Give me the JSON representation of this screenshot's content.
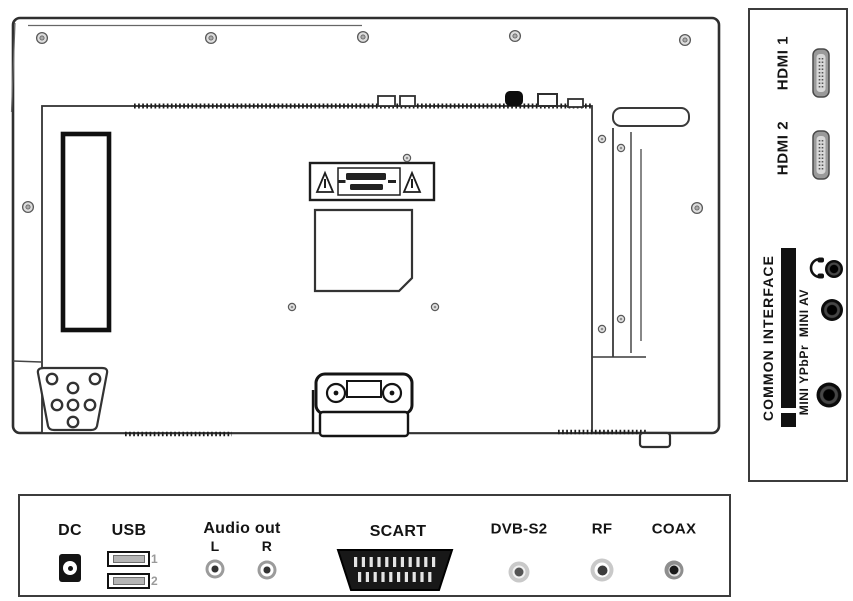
{
  "side_panel": {
    "hdmi1": {
      "label": "HDMI 1",
      "icon": "hdmi-connector-icon"
    },
    "hdmi2": {
      "label": "HDMI 2",
      "icon": "hdmi-connector-icon"
    },
    "common_interface": {
      "label": "COMMON INTERFACE",
      "icon": "ci-card-slot"
    },
    "headphone": {
      "icon": "headphone-icon"
    },
    "mini_av": {
      "label": "MINI AV",
      "icon": "mini-jack"
    },
    "mini_ypbpr": {
      "label": "MINI YPbPr",
      "icon": "mini-jack"
    }
  },
  "bottom_panel": {
    "dc": {
      "label": "DC",
      "icon": "dc-power-jack"
    },
    "usb": {
      "label": "USB",
      "numbers": [
        "1",
        "2"
      ],
      "icon": "usb-ports"
    },
    "audio_out": {
      "label": "Audio out",
      "left": "L",
      "right": "R",
      "icon": "rca-jacks"
    },
    "scart": {
      "label": "SCART",
      "icon": "scart-connector"
    },
    "dvb_s2": {
      "label": "DVB-S2",
      "icon": "coax-jack"
    },
    "rf": {
      "label": "RF",
      "icon": "coax-jack"
    },
    "coax": {
      "label": "COAX",
      "icon": "coax-jack"
    }
  },
  "rear_view": {
    "caution_label": {
      "icon": "warning-triangle-icon"
    }
  },
  "colors": {
    "line": "#2f2f2f",
    "dark": "#111111",
    "connector_gray": "#9a9a9a",
    "jack_ring_light": "#c9c9c9",
    "muted_label": "#9a9a9a"
  }
}
